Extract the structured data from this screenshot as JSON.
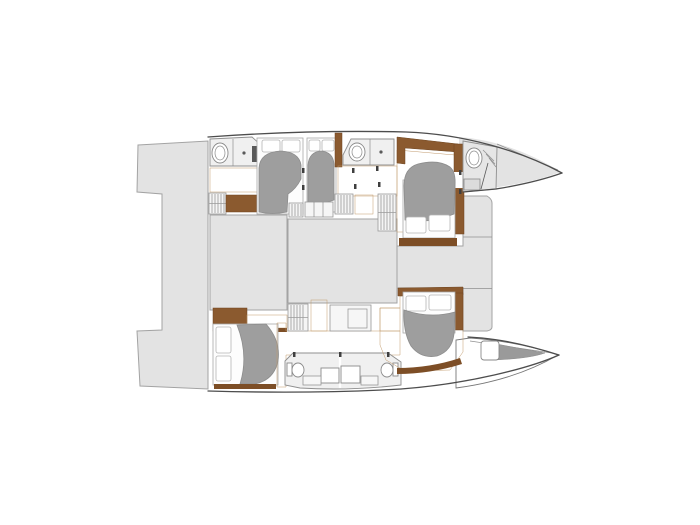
{
  "title": "Catamaran yacht interior layout plan, top-down view, bow pointing right",
  "canvas": {
    "width": 700,
    "height": 525,
    "background": "#ffffff"
  },
  "colors": {
    "c-bg": "#ffffff",
    "c-deck": "#e3e3e3",
    "c-deck-border": "#a3a3a3",
    "c-room": "#f0f0f0",
    "c-room-border": "#8f8f8f",
    "c-wood": "#e5c79e",
    "c-wood-line": "#c9a276",
    "c-brown": "#8b5a2f",
    "c-brown-dark": "#7d4e26",
    "c-duvet": "#9e9e9e",
    "c-duvet-edge": "#8d8d8d",
    "c-mattress": "#fdfdfd",
    "c-fixture-border": "#8a8a8a",
    "c-hatch": "#9a9a9a",
    "c-outline": "#4d4d4d",
    "c-forepeak": "#9a9a9a",
    "c-pin": "#3f3f3f"
  },
  "vessel": {
    "type": "catamaran",
    "view": "top-down interior floor plan",
    "bow_direction": "right",
    "hulls": 2,
    "double_beds": 5,
    "bathrooms": 4,
    "port_hull_top": {
      "spaces": [
        "aft-bathroom",
        "aft-double-cabin",
        "mid-double-cabin",
        "mid-bathroom",
        "forward-double-cabin",
        "bow-bathroom",
        "bow-deck"
      ]
    },
    "starboard_hull_bottom": {
      "spaces": [
        "aft-double-cabin",
        "wardrobe-and-counter",
        "companionway-steps",
        "galley-unit",
        "twin-bathrooms",
        "forward-double-cabin",
        "bow-locker",
        "bow-deck"
      ]
    },
    "center_structures": [
      "port-transom-platform",
      "starboard-transom-platform",
      "aft-platform-band",
      "saloon-block",
      "cockpit-block",
      "foredeck-block"
    ]
  },
  "inventory": {
    "beds": 5,
    "pillows": 10,
    "toilets": 4,
    "sinks": 2,
    "showers": 2,
    "step-ladders": 6,
    "wood-floor-areas": 9,
    "transom-platforms": 2
  }
}
